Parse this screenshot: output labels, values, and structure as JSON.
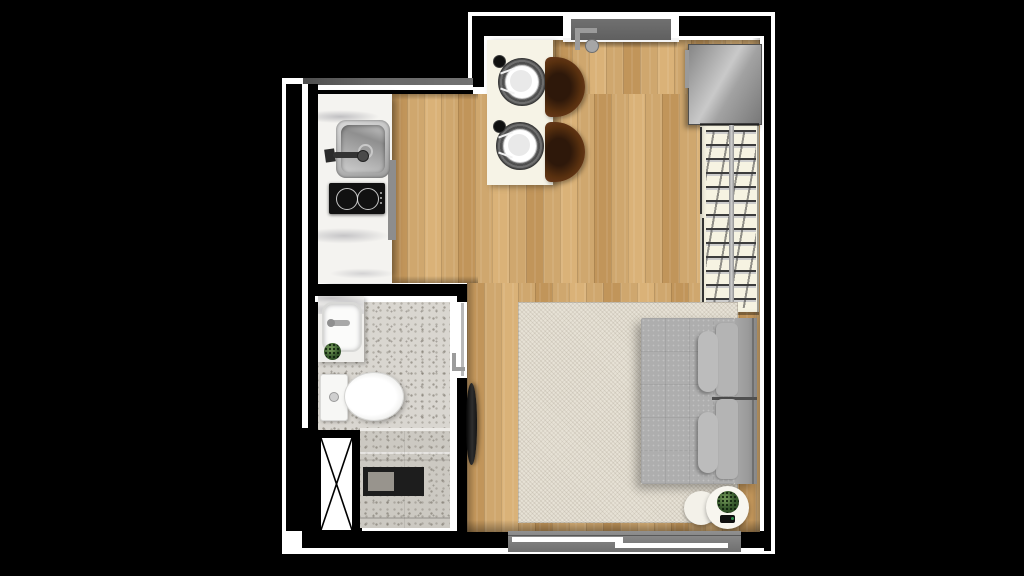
{
  "scene": {
    "title": "Studio apartment floor plan - top-down 3D render",
    "background": "#000000"
  },
  "palette": {
    "wall": "#000000",
    "wall_outline": "#ffffff",
    "wall_cap": "#666666",
    "wood_floor": "#cfa76e",
    "wood_floor_dark": "#c1955a",
    "wood_floor_light": "#dab278",
    "marble": "#f4f3f0",
    "terrazzo": "#d9d6d0",
    "terrazzo_dark": "#ccc9c2",
    "steel": "#b9b9b9",
    "cooktop": "#111111",
    "table": "#f6f3e6",
    "placemat": "#4f4f4f",
    "chair": "#6b3a1c",
    "chair_dark": "#2e180a",
    "closet": "#f6f3e2",
    "rod": "#b5b5b5",
    "rug": "#e7e2d6",
    "sofa": "#aeaeae",
    "sofa_back": "#9a9a9a",
    "cushion": "#bcbcbc",
    "fixture": "#fbfbfa",
    "mat": "#1d1d1d",
    "door": "#606060",
    "window_frame": "#828282",
    "glass_rail": "#ffffff",
    "plant": "#3a5c2f",
    "plant_dark": "#24401d",
    "tv": "#141414"
  },
  "rooms": [
    {
      "name": "entry-dining"
    },
    {
      "name": "kitchen"
    },
    {
      "name": "bathroom"
    },
    {
      "name": "wardrobe-nook"
    },
    {
      "name": "living-sleeping-area"
    },
    {
      "name": "balcony-window"
    }
  ],
  "labels": {
    "plan": "Studio apartment floor plan render",
    "counter": "Kitchen counter with marble top",
    "sink": "Kitchen sink",
    "cooktop": "Induction cooktop",
    "dining_table": "Dining table with two place settings",
    "place_setting": "Place setting",
    "chair": "Dining chair",
    "fridge": "Refrigerator",
    "wardrobe": "Open wardrobe with clothes hangers",
    "entry_door": "Entry door",
    "bath_door": "Bathroom sliding door",
    "vanity": "Bathroom vanity with basin",
    "toilet": "Toilet",
    "shower": "Shower area",
    "shower_mat": "Shower mat",
    "duct": "Ventilation shaft",
    "tv": "Wall-mounted TV",
    "rug": "Area rug",
    "sofa_bed": "Sofa bed",
    "cushion": "Cushion",
    "side_table": "Round side table",
    "plant": "Potted plant",
    "window": "Sliding window"
  }
}
